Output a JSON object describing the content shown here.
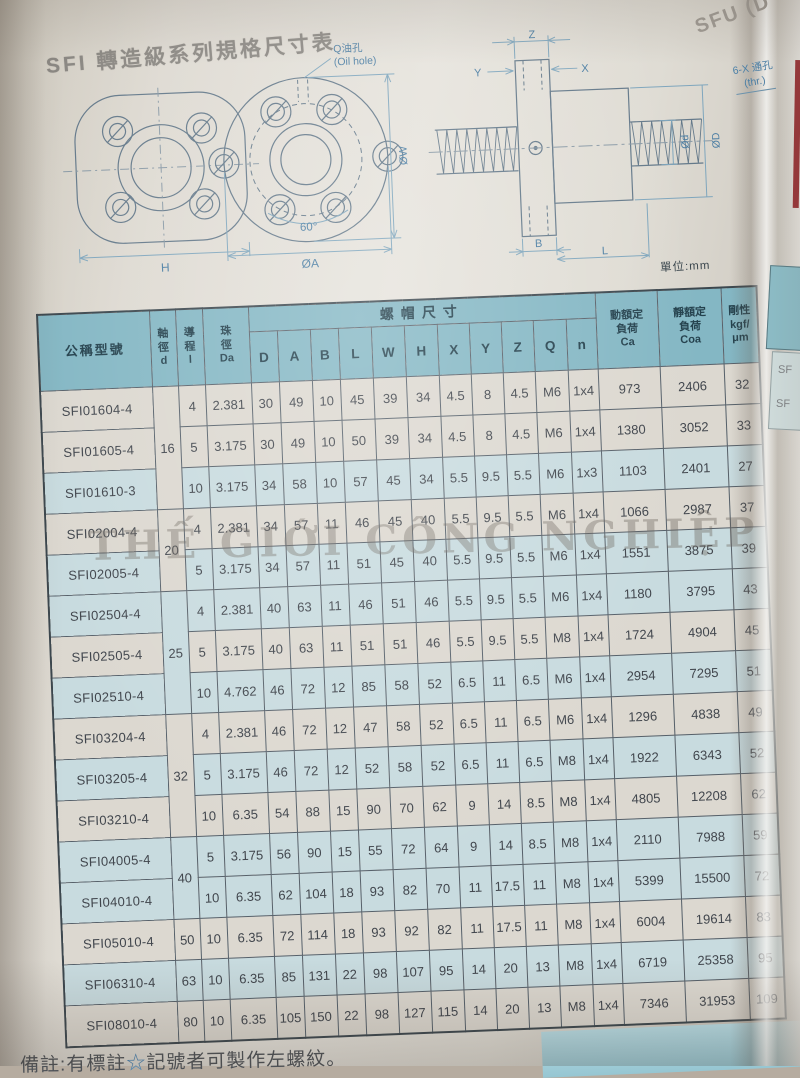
{
  "page": {
    "title": "SFI 轉造級系列規格尺寸表",
    "unit_label": "單位:mm",
    "watermark": "THẾ GIỚI CÔNG NGHIỆP",
    "note_prefix": "備註:有標註",
    "note_star": "☆",
    "note_suffix": "記號者可製作左螺紋。",
    "next_page": {
      "title_fragment": "SFU (D",
      "label_line1": "6-X 通孔",
      "label_line2": "(thr.)",
      "row_fragment": "SF"
    }
  },
  "drawings": {
    "oil_hole_cn": "Q油孔",
    "oil_hole_en": "(Oil hole)",
    "dim_h": "H",
    "dim_ow": "ØW",
    "dim_60": "60°",
    "dim_oa": "ØA",
    "dim_z": "Z",
    "dim_y": "Y",
    "dim_x": "X",
    "dim_od_small": "Ød",
    "dim_od_big": "ØD",
    "dim_b": "B",
    "dim_l": "L"
  },
  "table": {
    "star_glyph": "☆",
    "headers": {
      "model": "公稱型號",
      "shaft": "軸\n徑\nd",
      "lead": "導\n程\nl",
      "ball": "珠\n徑\nDa",
      "nut_group": "螺帽尺寸",
      "nut_cols": [
        "D",
        "A",
        "B",
        "L",
        "W",
        "H",
        "X",
        "Y",
        "Z",
        "Q",
        "n"
      ],
      "ca": "動額定\n負荷\nCa",
      "coa": "靜額定\n負荷\nCoa",
      "stiffness": "剛性\nkgf/\nμm"
    },
    "rows": [
      {
        "model": "SFI01604-4",
        "star": false,
        "d": "16",
        "dspan": 3,
        "lead": "4",
        "da": "2.381",
        "nut": [
          "30",
          "49",
          "10",
          "45",
          "39",
          "34",
          "4.5",
          "8",
          "4.5",
          "M6",
          "1x4"
        ],
        "ca": "973",
        "coa": "2406",
        "k": "32",
        "shade": "w"
      },
      {
        "model": "SFI01605-4",
        "star": true,
        "dspan": 0,
        "lead": "5",
        "da": "3.175",
        "nut": [
          "30",
          "49",
          "10",
          "50",
          "39",
          "34",
          "4.5",
          "8",
          "4.5",
          "M6",
          "1x4"
        ],
        "ca": "1380",
        "coa": "3052",
        "k": "33",
        "shade": "w"
      },
      {
        "model": "SFI01610-3",
        "star": false,
        "dspan": 0,
        "lead": "10",
        "da": "3.175",
        "nut": [
          "34",
          "58",
          "10",
          "57",
          "45",
          "34",
          "5.5",
          "9.5",
          "5.5",
          "M6",
          "1x3"
        ],
        "ca": "1103",
        "coa": "2401",
        "k": "27",
        "shade": "b"
      },
      {
        "model": "SFI02004-4",
        "star": false,
        "d": "20",
        "dspan": 2,
        "lead": "4",
        "da": "2.381",
        "nut": [
          "34",
          "57",
          "11",
          "46",
          "45",
          "40",
          "5.5",
          "9.5",
          "5.5",
          "M6",
          "1x4"
        ],
        "ca": "1066",
        "coa": "2987",
        "k": "37",
        "shade": "w"
      },
      {
        "model": "SFI02005-4",
        "star": true,
        "dspan": 0,
        "lead": "5",
        "da": "3.175",
        "nut": [
          "34",
          "57",
          "11",
          "51",
          "45",
          "40",
          "5.5",
          "9.5",
          "5.5",
          "M6",
          "1x4"
        ],
        "ca": "1551",
        "coa": "3875",
        "k": "39",
        "shade": "b"
      },
      {
        "model": "SFI02504-4",
        "star": false,
        "d": "25",
        "dspan": 3,
        "lead": "4",
        "da": "2.381",
        "nut": [
          "40",
          "63",
          "11",
          "46",
          "51",
          "46",
          "5.5",
          "9.5",
          "5.5",
          "M6",
          "1x4"
        ],
        "ca": "1180",
        "coa": "3795",
        "k": "43",
        "shade": "b"
      },
      {
        "model": "SFI02505-4",
        "star": true,
        "dspan": 0,
        "lead": "5",
        "da": "3.175",
        "nut": [
          "40",
          "63",
          "11",
          "51",
          "51",
          "46",
          "5.5",
          "9.5",
          "5.5",
          "M8",
          "1x4"
        ],
        "ca": "1724",
        "coa": "4904",
        "k": "45",
        "shade": "w"
      },
      {
        "model": "SFI02510-4",
        "star": false,
        "dspan": 0,
        "lead": "10",
        "da": "4.762",
        "nut": [
          "46",
          "72",
          "12",
          "85",
          "58",
          "52",
          "6.5",
          "11",
          "6.5",
          "M6",
          "1x4"
        ],
        "ca": "2954",
        "coa": "7295",
        "k": "51",
        "shade": "b"
      },
      {
        "model": "SFI03204-4",
        "star": false,
        "d": "32",
        "dspan": 3,
        "lead": "4",
        "da": "2.381",
        "nut": [
          "46",
          "72",
          "12",
          "47",
          "58",
          "52",
          "6.5",
          "11",
          "6.5",
          "M6",
          "1x4"
        ],
        "ca": "1296",
        "coa": "4838",
        "k": "49",
        "shade": "w"
      },
      {
        "model": "SFI03205-4",
        "star": true,
        "dspan": 0,
        "lead": "5",
        "da": "3.175",
        "nut": [
          "46",
          "72",
          "12",
          "52",
          "58",
          "52",
          "6.5",
          "11",
          "6.5",
          "M8",
          "1x4"
        ],
        "ca": "1922",
        "coa": "6343",
        "k": "52",
        "shade": "b"
      },
      {
        "model": "SFI03210-4",
        "star": true,
        "dspan": 0,
        "lead": "10",
        "da": "6.35",
        "nut": [
          "54",
          "88",
          "15",
          "90",
          "70",
          "62",
          "9",
          "14",
          "8.5",
          "M8",
          "1x4"
        ],
        "ca": "4805",
        "coa": "12208",
        "k": "62",
        "shade": "w"
      },
      {
        "model": "SFI04005-4",
        "star": true,
        "d": "40",
        "dspan": 2,
        "lead": "5",
        "da": "3.175",
        "nut": [
          "56",
          "90",
          "15",
          "55",
          "72",
          "64",
          "9",
          "14",
          "8.5",
          "M8",
          "1x4"
        ],
        "ca": "2110",
        "coa": "7988",
        "k": "59",
        "shade": "b"
      },
      {
        "model": "SFI04010-4",
        "star": true,
        "dspan": 0,
        "lead": "10",
        "da": "6.35",
        "nut": [
          "62",
          "104",
          "18",
          "93",
          "82",
          "70",
          "11",
          "17.5",
          "11",
          "M8",
          "1x4"
        ],
        "ca": "5399",
        "coa": "15500",
        "k": "72",
        "shade": "b"
      },
      {
        "model": "SFI05010-4",
        "star": true,
        "d": "50",
        "dspan": 1,
        "lead": "10",
        "da": "6.35",
        "nut": [
          "72",
          "114",
          "18",
          "93",
          "92",
          "82",
          "11",
          "17.5",
          "11",
          "M8",
          "1x4"
        ],
        "ca": "6004",
        "coa": "19614",
        "k": "83",
        "shade": "w"
      },
      {
        "model": "SFI06310-4",
        "star": false,
        "d": "63",
        "dspan": 1,
        "lead": "10",
        "da": "6.35",
        "nut": [
          "85",
          "131",
          "22",
          "98",
          "107",
          "95",
          "14",
          "20",
          "13",
          "M8",
          "1x4"
        ],
        "ca": "6719",
        "coa": "25358",
        "k": "95",
        "shade": "b"
      },
      {
        "model": "SFI08010-4",
        "star": false,
        "d": "80",
        "dspan": 1,
        "lead": "10",
        "da": "6.35",
        "nut": [
          "105",
          "150",
          "22",
          "98",
          "127",
          "115",
          "14",
          "20",
          "13",
          "M8",
          "1x4"
        ],
        "ca": "7346",
        "coa": "31953",
        "k": "109",
        "shade": "w"
      }
    ]
  }
}
